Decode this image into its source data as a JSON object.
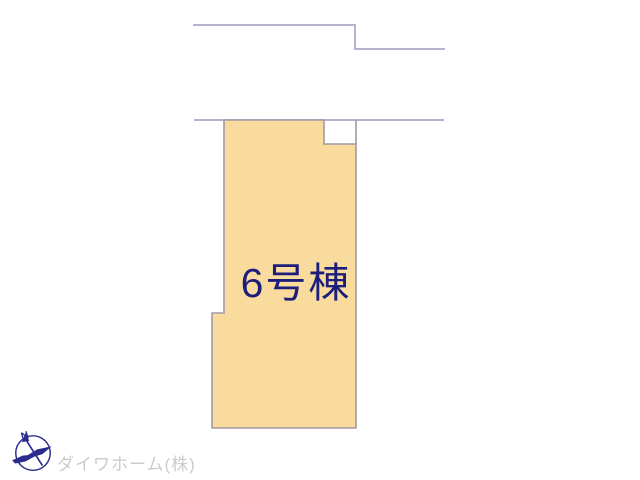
{
  "site_plan": {
    "plot": {
      "label": "6号棟"
    },
    "compass": {
      "north_label": "N"
    },
    "watermark": {
      "company": "ダイワホーム(株)"
    }
  },
  "colors": {
    "page_bg": "#ffffff",
    "plot_fill": "#f8db9d",
    "plot_stroke": "#a39aa3",
    "boundary_stroke": "#b4b3d1",
    "label_color": "#1d1d7c",
    "compass_color": "#2b2b8e",
    "watermark_color": "#cbcbcb"
  }
}
